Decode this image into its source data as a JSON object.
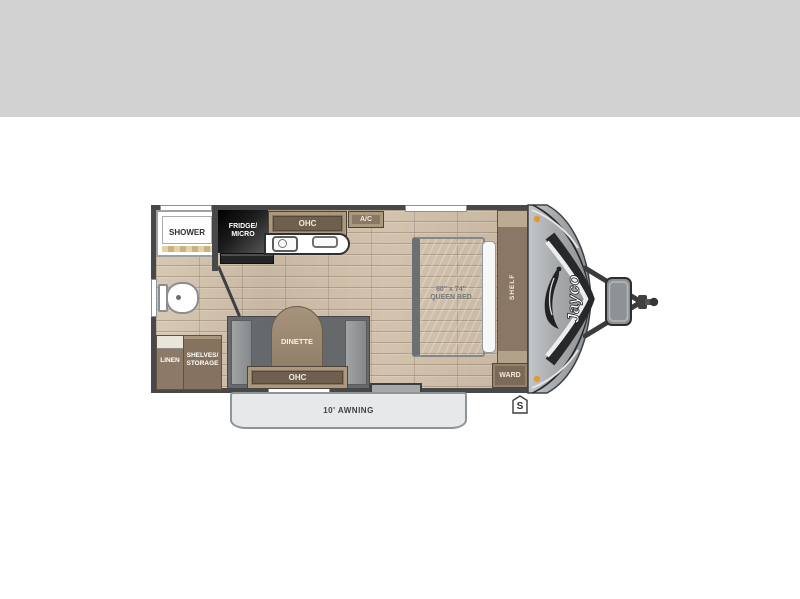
{
  "header": {
    "band_color": "#d2d2d2"
  },
  "floorplan": {
    "brand": "Jayco",
    "bathroom": {
      "shower_label": "SHOWER"
    },
    "kitchen": {
      "fridge_label": "FRIDGE/\nMICRO",
      "ohc_label": "OHC",
      "ac_label": "A/C"
    },
    "bedroom": {
      "bed_label": "60\" x 74\"\nQUEEN BED",
      "shelf_label": "SHELF",
      "ward_label": "WARD"
    },
    "dinette": {
      "label": "DINETTE",
      "ohc_label": "OHC"
    },
    "storage": {
      "linen_label": "LINEN",
      "shelves_label": "SHELVES/\nSTORAGE"
    },
    "exterior": {
      "awning_label": "10' AWNING",
      "stabilizer_label": "S"
    },
    "colors": {
      "wall": "#46484a",
      "floor_wood": "#ccbca8",
      "cabinet_brown": "#8a7765",
      "front_cap_gray": "#a7aaad",
      "marker_light_orange": "#e79833"
    }
  }
}
